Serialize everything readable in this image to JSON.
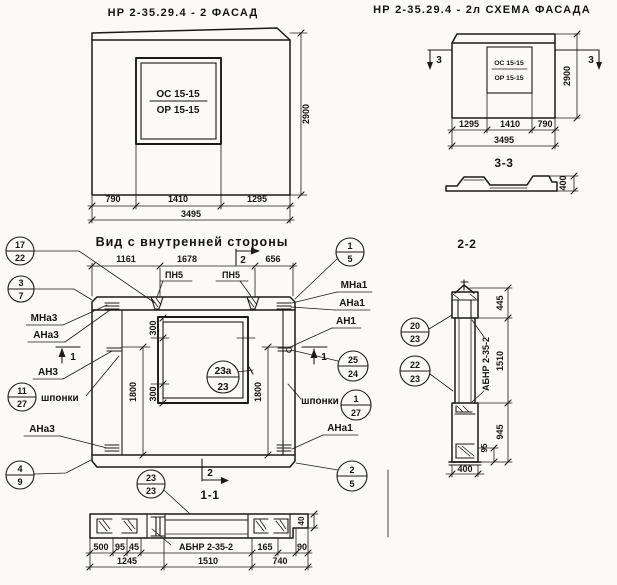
{
  "page": {
    "paper_color": "#fbfaf7",
    "ink_color": "#1a1a1a"
  },
  "facade": {
    "title": "НР 2-35.29.4 - 2 ФАСАД",
    "win_top": "ОС 15-15",
    "win_bot": "ОР 15-15",
    "h": "2900",
    "d1": "790",
    "d2": "1410",
    "d3": "1295",
    "total": "3495"
  },
  "schema": {
    "title": "НР 2-35.29.4 - 2л СХЕМА ФАСАДА",
    "win_top": "ОС 15-15",
    "win_bot": "ОР 15-15",
    "h": "2900",
    "d1": "1295",
    "d2": "1410",
    "d3": "790",
    "total": "3495",
    "sec": "3"
  },
  "s33": {
    "title": "3-3",
    "t": "400"
  },
  "inner": {
    "title": "Вид с внутренней стороны",
    "d1": "1161",
    "d2": "1678",
    "d3": "656",
    "pn": "ПН5",
    "w300": "300",
    "h1800": "1800",
    "mna3": "МНа3",
    "ana3": "АНа3",
    "an3": "АН3",
    "shp": "шпонки",
    "ana3b": "АНа3",
    "mna1": "МНа1",
    "ana1": "АНа1",
    "an1": "АН1",
    "shpr": "шпонки",
    "ana1b": "АНа1",
    "sec1": "1",
    "sec2": "2"
  },
  "callouts": {
    "c17": {
      "t": "17",
      "b": "22"
    },
    "c37": {
      "t": "3",
      "b": "7"
    },
    "c1127": {
      "t": "11",
      "b": "27"
    },
    "c49": {
      "t": "4",
      "b": "9"
    },
    "c15": {
      "t": "1",
      "b": "5"
    },
    "c2524": {
      "t": "25",
      "b": "24"
    },
    "c127": {
      "t": "1",
      "b": "27"
    },
    "c25": {
      "t": "2",
      "b": "5"
    },
    "c23a": {
      "t": "23а",
      "b": "23"
    },
    "c2023": {
      "t": "20",
      "b": "23"
    },
    "c2223": {
      "t": "22",
      "b": "23"
    },
    "c2323": {
      "t": "23",
      "b": "23"
    }
  },
  "s22": {
    "title": "2-2",
    "label": "АБНР 2-35-2",
    "d445": "445",
    "d1510": "1510",
    "d945": "945",
    "d95": "95",
    "d400": "400"
  },
  "s11": {
    "title": "1-1",
    "label": "АБНР 2-35-2",
    "d500": "500",
    "d95": "95",
    "d45": "45",
    "d165": "165",
    "d90": "90",
    "d40": "40",
    "d1245": "1245",
    "d1510": "1510",
    "d740": "740"
  }
}
